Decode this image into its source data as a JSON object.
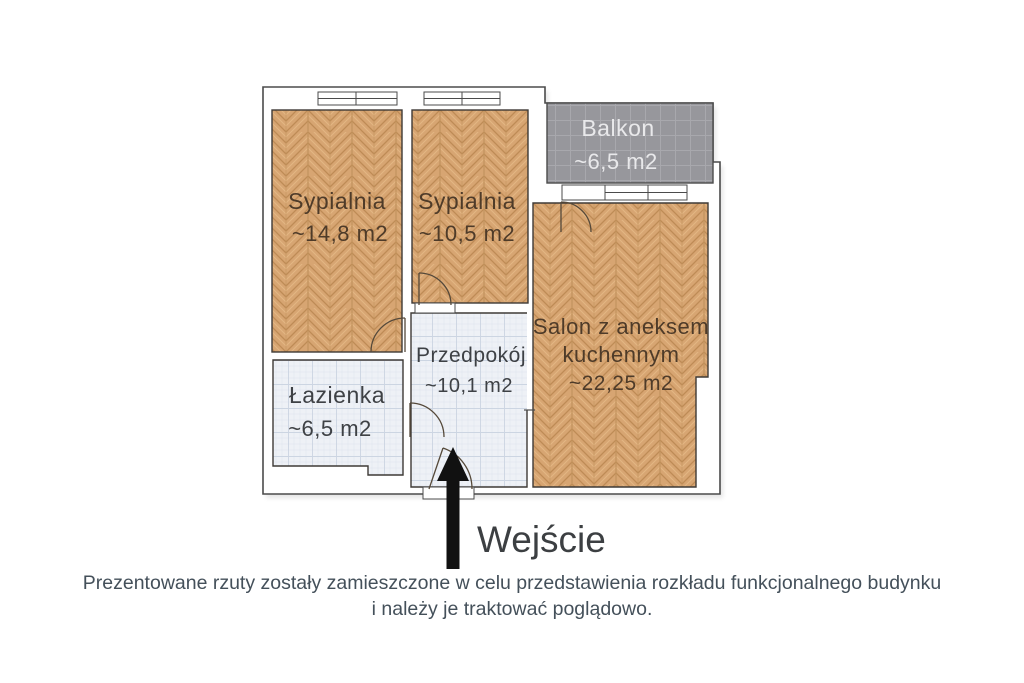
{
  "plan": {
    "rooms": [
      {
        "id": "bedroom-1",
        "name": "Sypialnia",
        "area": "~14,8 m2"
      },
      {
        "id": "bedroom-2",
        "name": "Sypialnia",
        "area": "~10,5 m2"
      },
      {
        "id": "balcony",
        "name": "Balkon",
        "area": "~6,5 m2"
      },
      {
        "id": "living-room",
        "name_line1": "Salon z aneksem",
        "name_line2": "kuchennym",
        "area": "~22,25 m2"
      },
      {
        "id": "hallway",
        "name": "Przedpokój",
        "area": "~10,1 m2"
      },
      {
        "id": "bathroom",
        "name": "Łazienka",
        "area": "~6,5 m2"
      }
    ],
    "entrance_label": "Wejście"
  },
  "footer": {
    "line1": "Prezentowane rzuty zostały zamieszczone w celu przedstawienia rozkładu funkcjonalnego budynku",
    "line2": "i należy je traktować poglądowo."
  },
  "colors": {
    "wood_floor": "#d7a572",
    "wood_text": "#4e3b29",
    "balcony_fill": "#97979c",
    "balcony_text": "#e9e9eb",
    "tile_floor": "#eef1f6",
    "tile_text": "#3e4145",
    "wall_outline": "#4b4b4b",
    "door_stroke": "#55493a",
    "arrow_fill": "#111111",
    "entrance_text": "#3c3f42",
    "footer_text": "#44505a"
  }
}
